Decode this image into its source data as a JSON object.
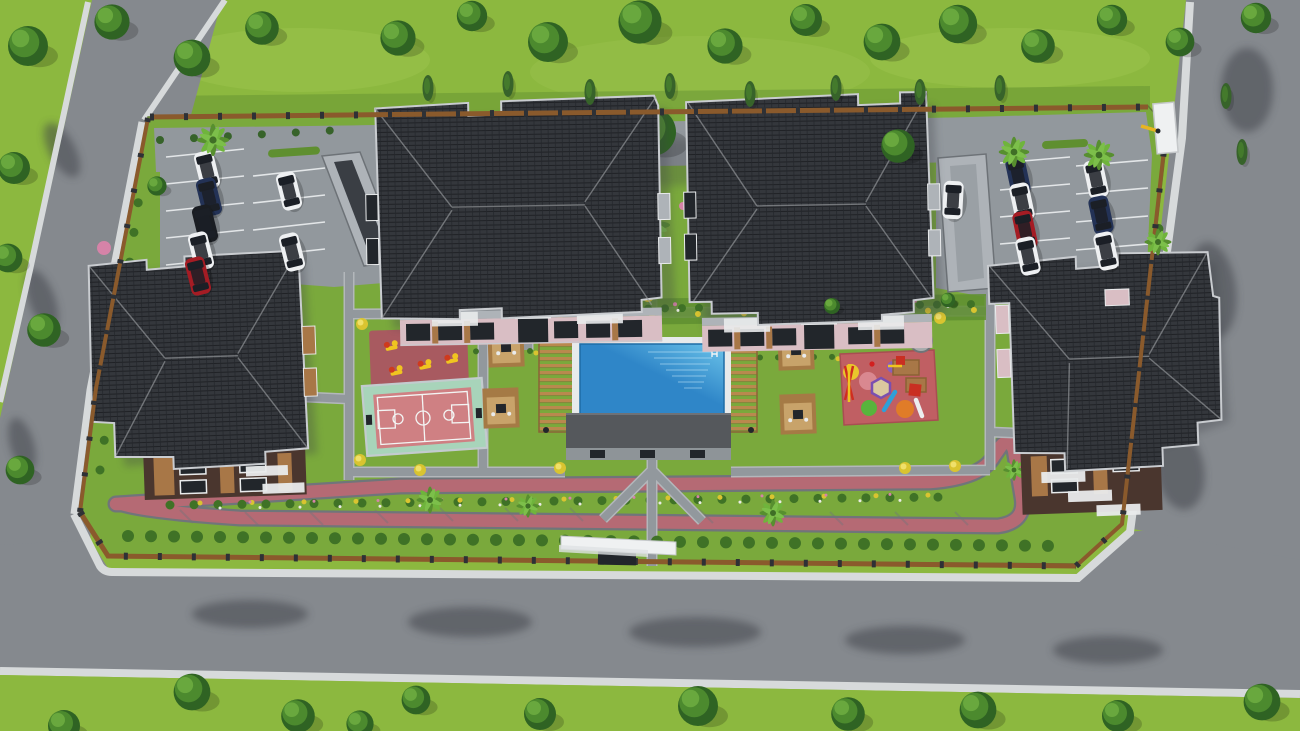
{
  "meta": {
    "title": "Aerial 3D render of a gated residential complex",
    "view": "top-down bird's-eye architectural visualization",
    "canvas": {
      "width": 1300,
      "height": 731
    }
  },
  "palette": {
    "grassOuter": "#8cb83f",
    "grassInner": "#7aa93c",
    "grassLight": "#a3c854",
    "grassDark": "#5f8f30",
    "road": "#85898e",
    "roadShadow": "#5f646a",
    "sidewalk": "#d7dadb",
    "pathEdge": "#b3b7bb",
    "pave": "#92989d",
    "paveLight": "#aeb3b8",
    "paveDark": "#787e84",
    "stallLine": "#e3e6e8",
    "fenceWood": "#8a5a2c",
    "fencePost": "#2e3136",
    "trackPink": "#b56a74",
    "trackCurb": "#70757a",
    "roofDark": "#27292d",
    "roofTile": "#34373c",
    "roofRidge": "#97999d",
    "eave": "#c9ccd0",
    "facadePink": "#d9bec4",
    "brick": "#4a362e",
    "wood": "#a87747",
    "glass": "#22262b",
    "frame": "#e9ebec",
    "poolDeck": "#e7eaeb",
    "poolDeep": "#2f86c8",
    "poolLight": "#6cc4ea",
    "phRoof": "#55585c",
    "phWall": "#8e9498",
    "pergola": "#b9894e",
    "pergolaShade": "#8a6437",
    "cabanaWood": "#a57a45",
    "cabanaFloor": "#c8a36a",
    "courtPink": "#cf8083",
    "courtMint": "#a8d4ba",
    "courtLine": "#f3f5f4",
    "cage": "#c3cbce",
    "fitnessPad": "#a85a60",
    "eqYellow": "#f0c520",
    "eqRed": "#cf3a1e",
    "playPad": "#c05f63",
    "sand": "#dbc99f",
    "slideBlue": "#2e9fd8",
    "treeDark": "#2f6323",
    "treeMid": "#4c8a2e",
    "treeLight": "#69a83e",
    "conifer": "#37632a",
    "bush": "#3f7226",
    "bushYellow": "#d9c430",
    "flowerPink": "#d583a8",
    "flowerWhite": "#e9ebe4",
    "carWhite": "#eef0f2",
    "carBlue": "#233256",
    "carBlack": "#1a1d22",
    "carRed": "#a51c24",
    "carGlass": "#1b1f26",
    "canopy": "#eff1f2",
    "barrier": "#e8b421",
    "stone": "#a7abac",
    "shadow": "#3c4146"
  },
  "scene": {
    "type": "3d architectural aerial render, no visible text",
    "site": {
      "shape": "walled rectangular compound bordered by roads on west, south and east",
      "buildings_count": 4
    },
    "buildings": [
      {
        "id": "block-west",
        "position": "left",
        "roof": "dark charcoal hip roof with notched outline",
        "facade": "dark brick with wood panels and white-framed windows"
      },
      {
        "id": "block-north-west",
        "position": "top-left",
        "roof": "dark charcoal hip roof",
        "facade": "pink and dark grey with balconies"
      },
      {
        "id": "block-north-east",
        "position": "top-right",
        "roof": "dark charcoal hip roof",
        "facade": "pink and dark grey with balconies"
      },
      {
        "id": "block-east",
        "position": "right",
        "roof": "dark charcoal hip roof",
        "facade": "dark brick with stepped white terraces"
      }
    ],
    "amenities": [
      {
        "id": "swimming-pool",
        "desc": "rectangular blue pool with white deck and ladder"
      },
      {
        "id": "pool-house",
        "desc": "flat dark-grey roofed changing building south of pool"
      },
      {
        "id": "pergola-west",
        "desc": "wooden slatted pergola west of pool"
      },
      {
        "id": "pergola-east",
        "desc": "wooden slatted pergola east of pool"
      },
      {
        "id": "cabanas",
        "count": 4,
        "desc": "square wooden seating cabanas flanking the pool"
      },
      {
        "id": "basketball-court",
        "desc": "pink court with mint apron, white markings and cage fence"
      },
      {
        "id": "outdoor-fitness-area",
        "desc": "dark pink pad with 6 yellow exercise machines"
      },
      {
        "id": "children-playground",
        "desc": "red rubber pad with hexagonal sandpit, slides, swings, colored circles"
      },
      {
        "id": "trampoline",
        "desc": "grey round trampoline"
      },
      {
        "id": "seating-circle",
        "desc": "round stone terrace with parasol"
      },
      {
        "id": "jogging-track",
        "desc": "pink running loop with planted median along the south lawn"
      }
    ],
    "parking": {
      "left_lot": {
        "cars": [
          "white-suv",
          "navy-sedan",
          "black-suv",
          "white-sedan",
          "red-hatchback",
          "white-sedan",
          "white-sedan"
        ]
      },
      "right_lot": {
        "cars": [
          "white-suv-moving",
          "navy-sedan",
          "white-sedan",
          "red-sedan",
          "white-sedan",
          "white-sedan",
          "navy-suv",
          "white-suv"
        ]
      },
      "ramps": 2
    },
    "entrances": [
      {
        "id": "vehicle-gate",
        "position": "north-east corner",
        "features": [
          "white canopy booth",
          "yellow barrier arm"
        ]
      },
      {
        "id": "pedestrian-gate",
        "position": "south center",
        "features": [
          "long white canopy sign (blank)",
          "dark gate"
        ]
      }
    ],
    "vegetation": {
      "perimeter_trees": "deciduous rows with cypresses along top and bottom",
      "palms": 9,
      "hedge_rows": "inside fence on west, south and east",
      "flower_beds": "mixed bed north of pool and in track median"
    }
  }
}
